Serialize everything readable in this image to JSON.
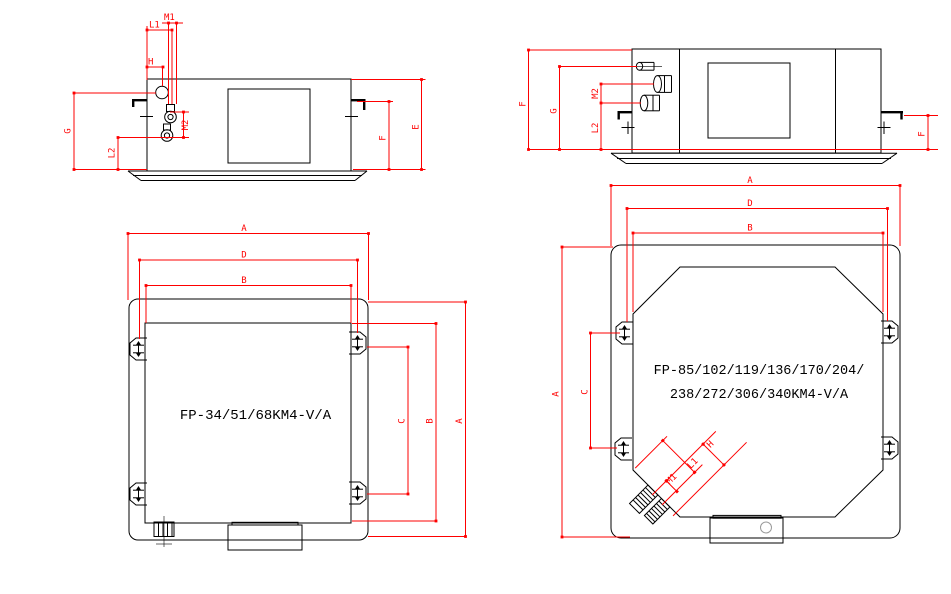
{
  "colors": {
    "dimension_red": "#fe0000",
    "drawing_black": "#000000",
    "knockout_gray": "#9a9a9a",
    "background": "#ffffff"
  },
  "views": {
    "small_side": {
      "dims": {
        "M1": "M1",
        "L1": "L1",
        "H": "H",
        "M2": "M2",
        "G": "G",
        "L2": "L2",
        "F": "F",
        "E": "E"
      }
    },
    "large_side": {
      "dims": {
        "F_left": "F",
        "G": "G",
        "M2": "M2",
        "L2": "L2",
        "F_right": "F"
      }
    },
    "small_plan": {
      "model": "FP-34/51/68KM4-V/A",
      "dims": {
        "A_top": "A",
        "D_top": "D",
        "B_top": "B",
        "C_side": "C",
        "B_side": "B",
        "A_side": "A"
      }
    },
    "large_plan": {
      "model_line1": "FP-85/102/119/136/170/204/",
      "model_line2": "238/272/306/340KM4-V/A",
      "dims": {
        "A_top": "A",
        "D_top": "D",
        "B_top": "B",
        "A_side": "A",
        "C_side": "C",
        "H": "H",
        "L1": "L1",
        "M1": "M1"
      }
    }
  }
}
